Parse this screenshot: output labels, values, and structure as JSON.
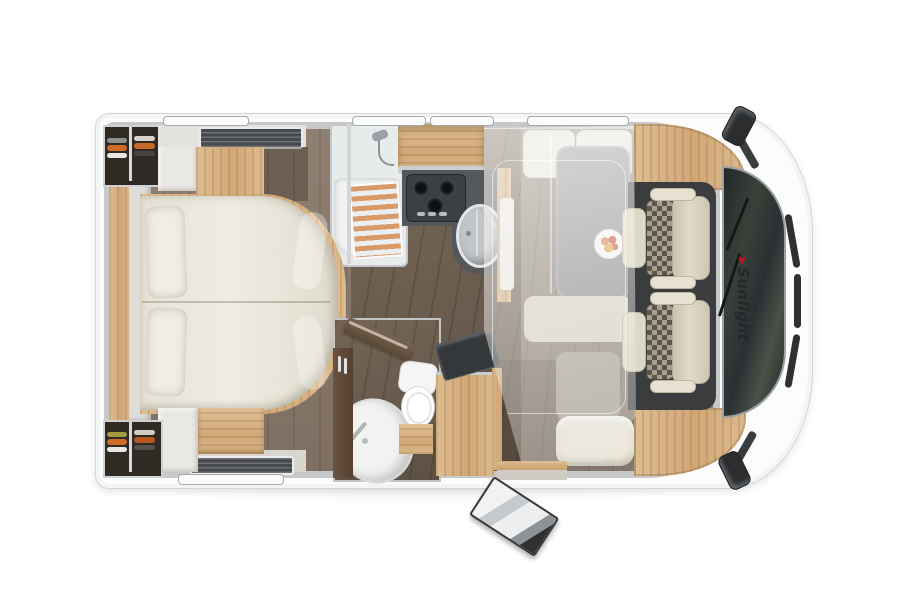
{
  "scene": {
    "description": "Top-down 3D rendering of a Sunlight motorhome interior floor plan, rear at left and driver cab at right",
    "background": "#ffffff"
  },
  "branding": {
    "logo_text": "Sunlight",
    "logo_icon": "red-swoosh",
    "logo_color": "#26272a",
    "logo_accent": "#c3151b"
  },
  "palette": {
    "body_white": "#fcfcfc",
    "wall_gray": "#c6c8ca",
    "wood_light": "#d9b586",
    "wood_dark": "#65503e",
    "floor_rear": "#87786b",
    "floor_mid": "#6e6053",
    "counter_dark": "#54575a",
    "mattress_cream": "#eae7dc",
    "seat_beige": "#d5cfbc",
    "cab_mat": "#3a3c3e",
    "windshield": "#2c3033",
    "clothes_orange": "#cf6a28"
  },
  "features": {
    "rooms": [
      "rear bedroom",
      "wardrobes",
      "shower",
      "kitchen",
      "bathroom",
      "dinette",
      "lounge bench",
      "driver cab"
    ],
    "fixtures": [
      "double bed with two pillows",
      "3-burner gas hob",
      "round kitchen sink",
      "dinette table with plate of food",
      "drop-down bed lowered (translucent)",
      "toilet",
      "corner washbasin",
      "tv on bracket",
      "two swivelled cab seats",
      "open entry door with steps",
      "two roof vents",
      "wing mirrors"
    ],
    "hob_burners": 3,
    "cab_seats": 2,
    "windows_top": 4,
    "windows_bottom": 1
  }
}
